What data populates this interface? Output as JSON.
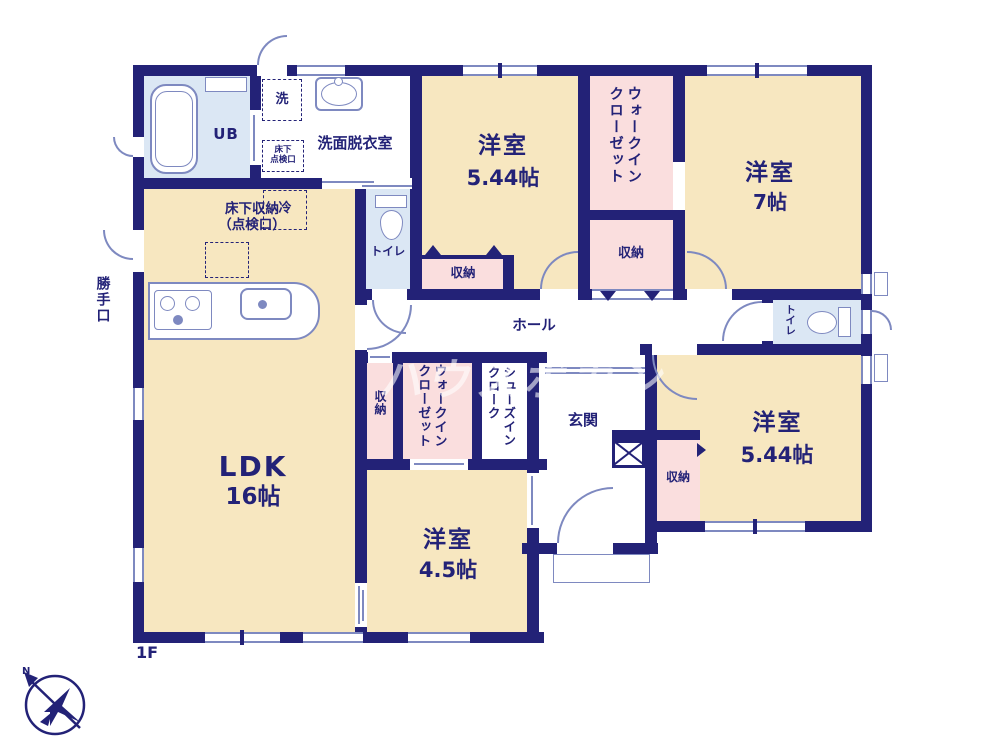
{
  "colors": {
    "wall": "#232277",
    "room_fill": "#f7e7c0",
    "closet_fill": "#fadede",
    "bath_fill": "#dbe7f4",
    "fixture_line": "#7e89c0",
    "text": "#232277",
    "watermark": "rgba(255,255,255,0.58)"
  },
  "floor": {
    "label": "1F"
  },
  "watermark": {
    "text": "ハウスボカン"
  },
  "compass": {
    "label": "N"
  },
  "rooms": {
    "ldk": {
      "name": "LDK",
      "size": "16帖"
    },
    "bedroom_top": {
      "name": "洋室",
      "size": "5.44帖"
    },
    "bedroom_right_top": {
      "name": "洋室",
      "size": "7帖"
    },
    "bedroom_right": {
      "name": "洋室",
      "size": "5.44帖"
    },
    "bedroom_bottom": {
      "name": "洋室",
      "size": "4.5帖"
    },
    "unit_bath": {
      "name": "UB"
    },
    "washroom": {
      "name": "洗面脱衣室"
    },
    "hall": {
      "name": "ホール"
    },
    "entrance": {
      "name": "玄関"
    },
    "toilet_top": {
      "name": "トイレ"
    },
    "toilet_right": {
      "name": "トイレ"
    },
    "walkin_closet_top": {
      "line1": "ウォークイン",
      "line2": "クローゼット"
    },
    "walkin_closet_mid": {
      "line1": "ウォークイン",
      "line2": "クローゼット"
    },
    "shoes_in_cloak": {
      "line1": "シューズイン",
      "line2": "クローク"
    },
    "storage_top": {
      "name": "収納"
    },
    "storage_under_bedroom_top": {
      "name": "収納"
    },
    "storage_hall": {
      "name": "収納"
    },
    "storage_entrance": {
      "name": "収納"
    },
    "back_door": {
      "name": "勝手口"
    }
  },
  "fixtures": {
    "washer": {
      "name": "洗"
    },
    "fridge": {
      "name": "冷"
    },
    "floor_hatch": {
      "line1": "床下",
      "line2": "点検口"
    },
    "floor_storage": {
      "line1": "床下収納",
      "line2": "（点検口）"
    }
  }
}
